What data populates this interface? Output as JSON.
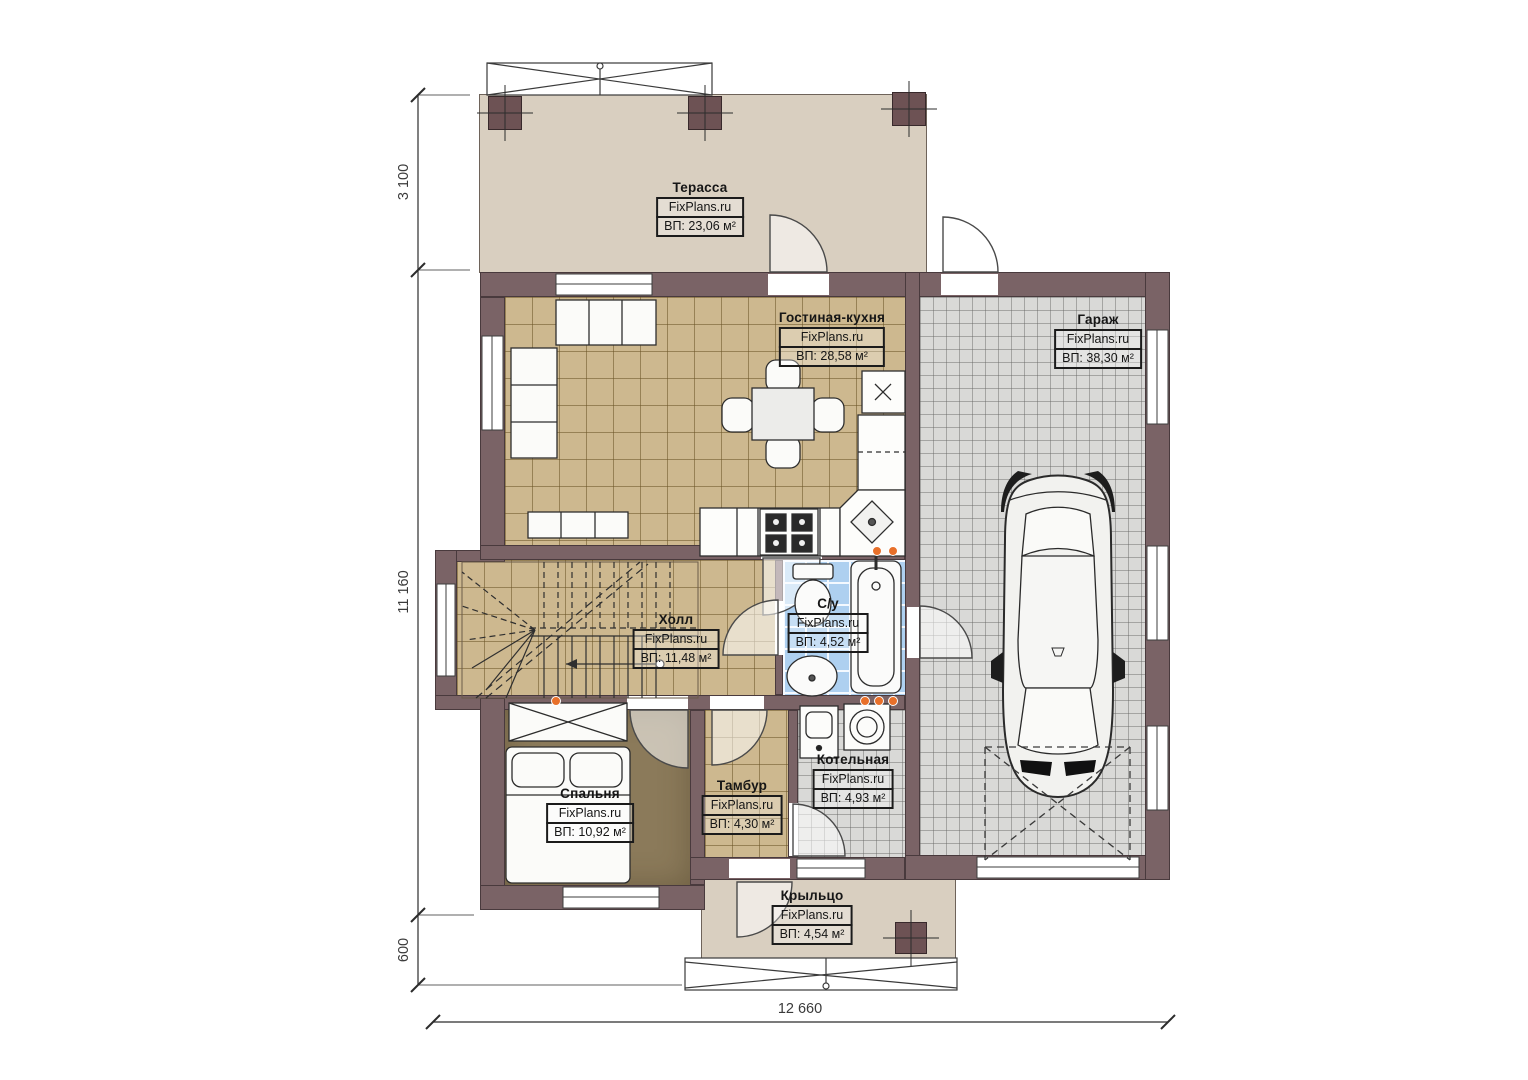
{
  "plan": {
    "watermark": "FixPlans.ru",
    "rooms": [
      {
        "id": "terrace",
        "name": "Терасса",
        "area": "ВП: 23,06 м²"
      },
      {
        "id": "living-kitchen",
        "name": "Гостиная-кухня",
        "area": "ВП: 28,58 м²"
      },
      {
        "id": "garage",
        "name": "Гараж",
        "area": "ВП: 38,30 м²"
      },
      {
        "id": "hall",
        "name": "Холл",
        "area": "ВП: 11,48 м²"
      },
      {
        "id": "bathroom",
        "name": "С/у",
        "area": "ВП: 4,52 м²"
      },
      {
        "id": "bedroom",
        "name": "Спальня",
        "area": "ВП: 10,92 м²"
      },
      {
        "id": "tambur",
        "name": "Тамбур",
        "area": "ВП: 4,30 м²"
      },
      {
        "id": "boiler",
        "name": "Котельная",
        "area": "ВП: 4,93 м²"
      },
      {
        "id": "porch",
        "name": "Крыльцо",
        "area": "ВП: 4,54 м²"
      }
    ],
    "dimensions": {
      "left_top": "3 100",
      "left_middle": "11 160",
      "left_bottom": "600",
      "bottom": "12 660"
    },
    "colors": {
      "wall": "#7a6366",
      "terrace_floor": "#d9cfc0",
      "tile_floor": "#cdb88f",
      "garage_floor": "#d9d9d7",
      "bathroom_floor": "#aed0f0",
      "bedroom_floor": "#8b7a5a",
      "marker_orange": "#e8702a"
    }
  }
}
